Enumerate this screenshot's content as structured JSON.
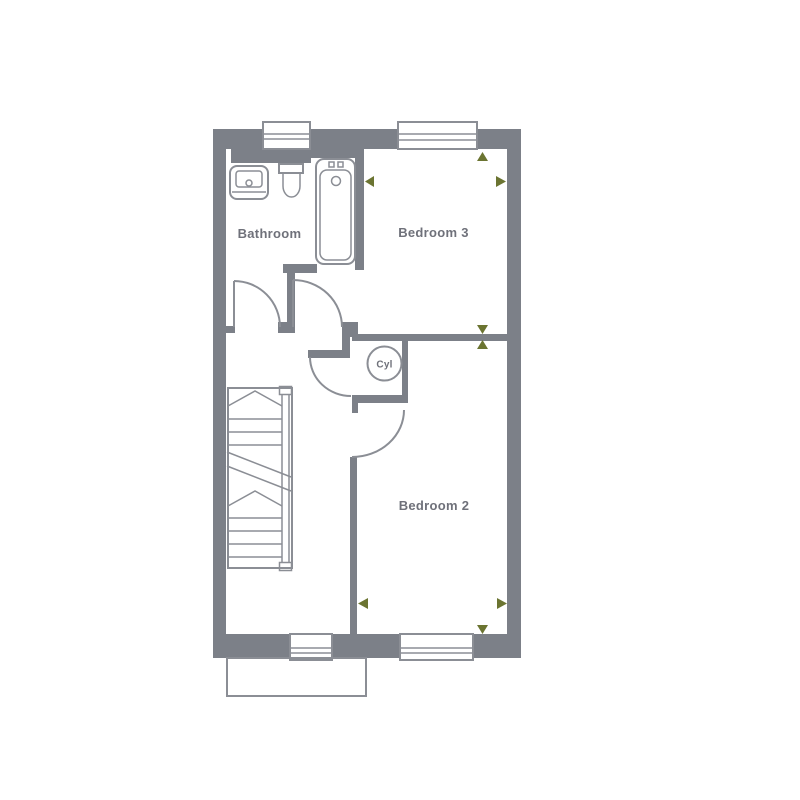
{
  "floorplan": {
    "labels": {
      "bathroom": "Bathroom",
      "bedroom3": "Bedroom 3",
      "bedroom2": "Bedroom 2",
      "cylinder": "Cyl"
    },
    "colors": {
      "wall": "#7c8088",
      "line": "#8b8e95",
      "text": "#6f717a",
      "marker": "#6b7431",
      "window_fill": "#ffffff"
    },
    "markers": [
      {
        "name": "marker-bed3-north",
        "direction": "up"
      },
      {
        "name": "marker-bed3-west",
        "direction": "left"
      },
      {
        "name": "marker-bed3-east",
        "direction": "right"
      },
      {
        "name": "marker-divider-top",
        "direction": "down"
      },
      {
        "name": "marker-divider-bottom",
        "direction": "up"
      },
      {
        "name": "marker-bed2-west",
        "direction": "left"
      },
      {
        "name": "marker-bed2-east",
        "direction": "right"
      },
      {
        "name": "marker-bed2-south",
        "direction": "down"
      }
    ],
    "rooms": [
      "Bathroom",
      "Bedroom 3",
      "Bedroom 2"
    ],
    "features": [
      "stairs",
      "bath",
      "sink",
      "toilet",
      "cylinder-cupboard",
      "porch-outline"
    ]
  }
}
